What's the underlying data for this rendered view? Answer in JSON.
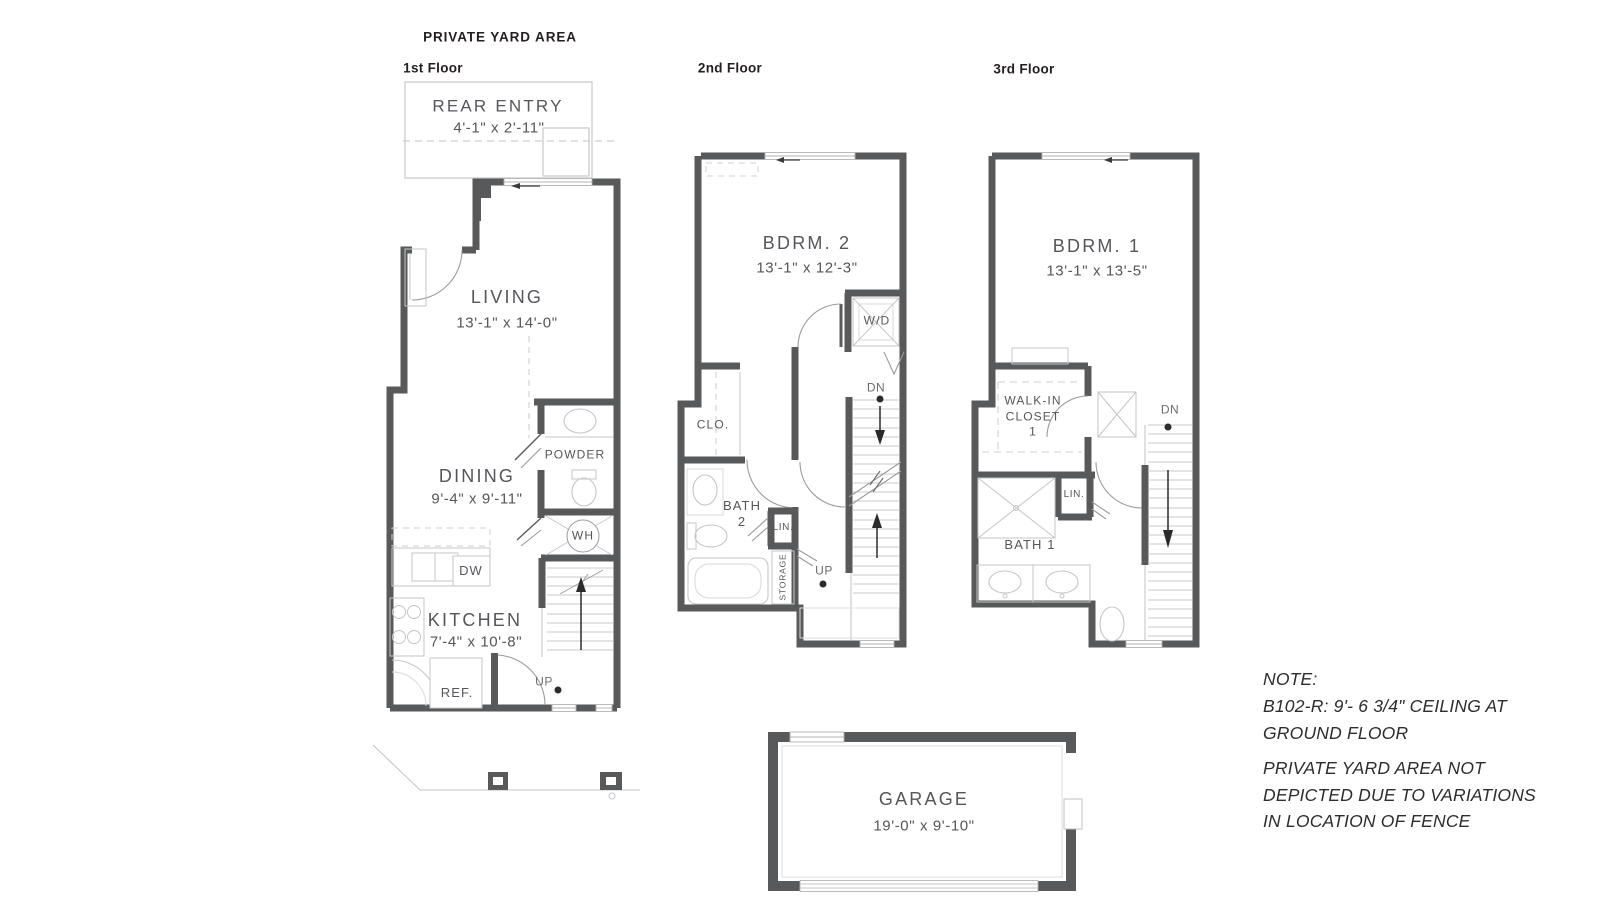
{
  "title": "PRIVATE YARD AREA",
  "floors": {
    "first": {
      "label": "1st Floor",
      "rear_entry_name": "REAR ENTRY",
      "rear_entry_dims": "4'-1\" x 2'-11\"",
      "living_name": "LIVING",
      "living_dims": "13'-1\" x 14'-0\"",
      "dining_name": "DINING",
      "dining_dims": "9'-4\" x 9'-11\"",
      "kitchen_name": "KITCHEN",
      "kitchen_dims": "7'-4\" x 10'-8\"",
      "powder": "POWDER",
      "water_heater": "WH",
      "dishwasher": "DW",
      "refrigerator": "REF.",
      "up": "UP"
    },
    "second": {
      "label": "2nd Floor",
      "bedroom_name": "BDRM. 2",
      "bedroom_dims": "13'-1\" x 12'-3\"",
      "washer_dryer": "W/D",
      "closet": "CLO.",
      "bath": "BATH\n2",
      "linen": "LIN.",
      "storage": "STORAGE",
      "dn": "DN",
      "up": "UP"
    },
    "third": {
      "label": "3rd Floor",
      "bedroom_name": "BDRM. 1",
      "bedroom_dims": "13'-1\" x 13'-5\"",
      "walk_in_closet": "WALK-IN\nCLOSET\n1",
      "linen": "LIN.",
      "bath": "BATH 1",
      "dn": "DN"
    }
  },
  "garage": {
    "name": "GARAGE",
    "dims": "19'-0\" x 9'-10\""
  },
  "note": {
    "heading": "NOTE:",
    "body1": "B102-R: 9'- 6 3/4\" CEILING AT\nGROUND FLOOR",
    "body2": "PRIVATE YARD AREA NOT\nDEPICTED DUE TO VARIATIONS\nIN LOCATION OF FENCE"
  },
  "colors": {
    "wall": "#58595b",
    "light_line": "#c6c6c6",
    "text": "#55565a",
    "title": "#231f20"
  }
}
